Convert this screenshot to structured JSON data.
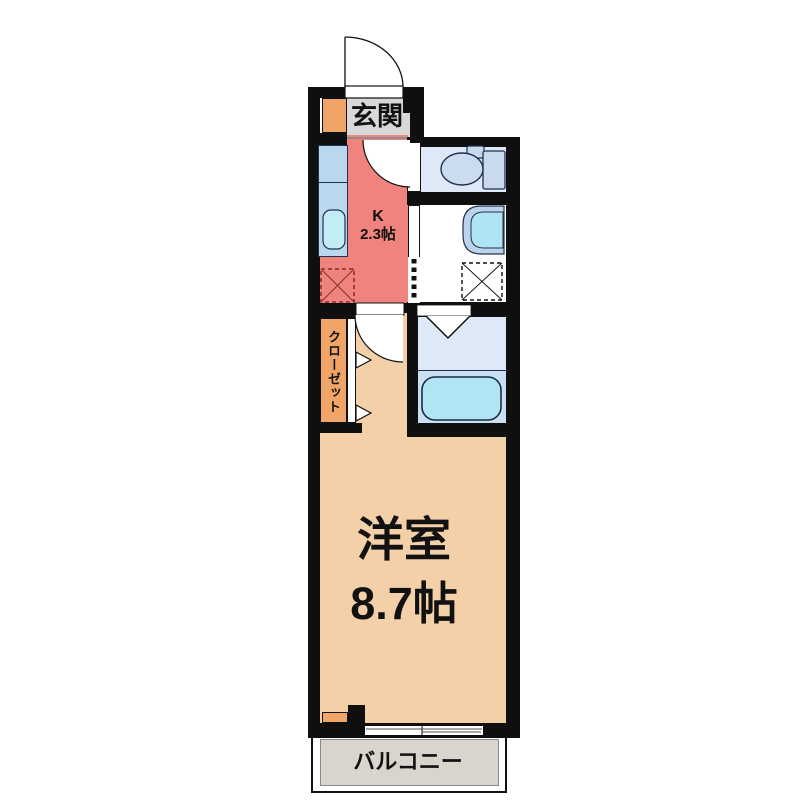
{
  "plan": {
    "rooms": {
      "genkan": {
        "label": "玄関"
      },
      "kitchen": {
        "label": "K",
        "size": "2.3帖"
      },
      "closet": {
        "label": "クローゼット"
      },
      "main_room": {
        "label": "洋室",
        "size": "8.7帖"
      },
      "balcony": {
        "label": "バルコニー"
      }
    },
    "fixtures": [
      "entrance-door",
      "shoe-cabinet",
      "kitchen-counter",
      "kitchen-sink",
      "stove-space",
      "toilet",
      "washbasin",
      "washing-machine-pan",
      "bathtub",
      "accordion-door",
      "folding-bath-door",
      "closet-folding-doors",
      "room-door",
      "sliding-window"
    ],
    "colors": {
      "wall": "#0f0f0f",
      "genkan_floor": "#d8d8d8",
      "kitchen_floor": "#f0837d",
      "main_floor": "#f4d0a9",
      "wet_area_floor": "#dde9f6",
      "bath_floor_lower": "#cadff2",
      "balcony_floor": "#d9d5cd",
      "cabinet_orange": "#f0a468",
      "counter_blue": "#b9d8ee",
      "fixture_blue": "#ccdcf0",
      "water_blue": "#b2e5f3",
      "stove_red": "#8a2f2f",
      "outline_navy": "#22304f"
    }
  }
}
